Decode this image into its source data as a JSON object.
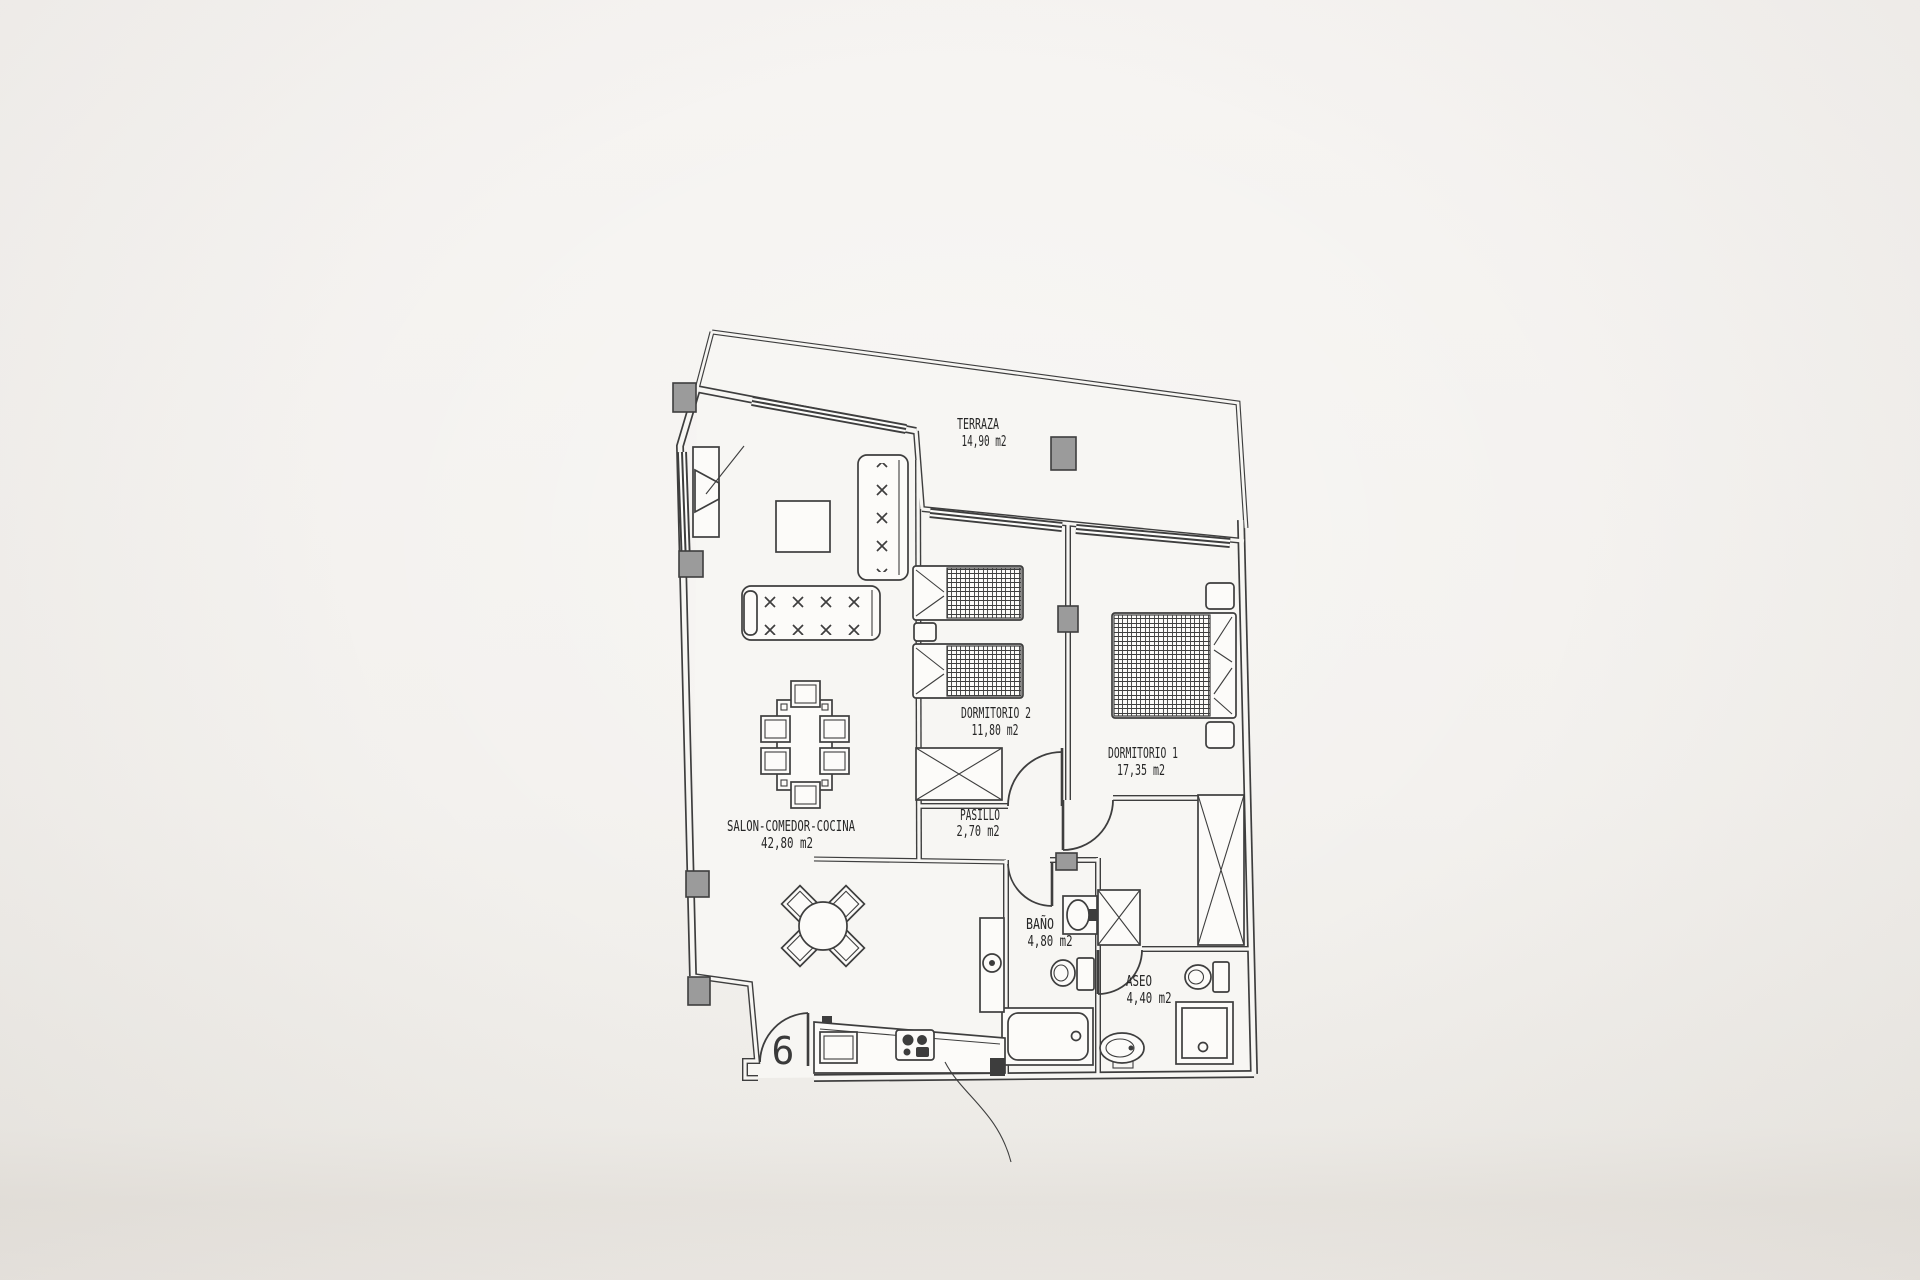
{
  "plan": {
    "rooms": [
      {
        "id": "terraza",
        "label": "TERRAZA",
        "area": "14,90 m2"
      },
      {
        "id": "dormitorio-2",
        "label": "DORMITORIO 2",
        "area": "11,80 m2"
      },
      {
        "id": "dormitorio-1",
        "label": "DORMITORIO 1",
        "area": "17,35 m2"
      },
      {
        "id": "pasillo",
        "label": "PASILLO",
        "area": "2,70 m2"
      },
      {
        "id": "salon",
        "label": "SALON-COMEDOR-COCINA",
        "area": "42,80 m2"
      },
      {
        "id": "bano",
        "label": "BAÑO",
        "area": "4,80 m2"
      },
      {
        "id": "aseo",
        "label": "ASEO",
        "area": "4,40 m2"
      }
    ],
    "unit_number": "6",
    "colors": {
      "wall_line": "#3e3e3e",
      "column_fill": "#9b9b9b",
      "paper": "#f3f1ee",
      "floor": "#f7f6f3"
    }
  }
}
